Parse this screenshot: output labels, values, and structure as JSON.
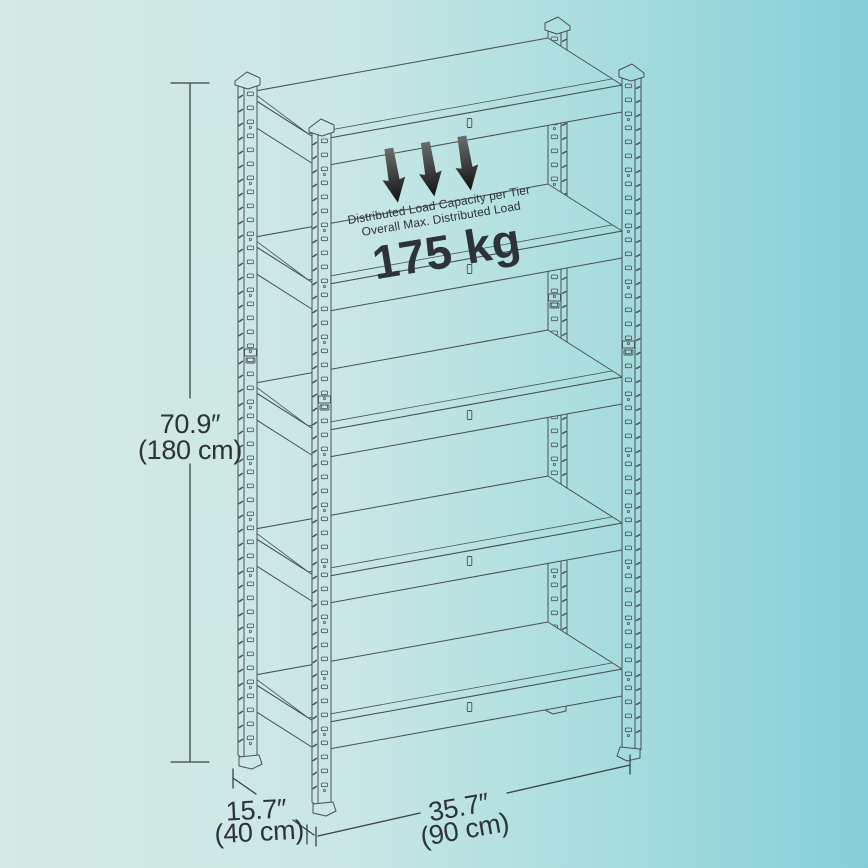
{
  "background": {
    "left": "#d6e9e4",
    "mid": "#c9e7e5",
    "teal": "#a5dcde",
    "right": "#85ced8"
  },
  "colors": {
    "line": "#495054",
    "dim_line": "#3c4246",
    "text": "#2d3337",
    "arrow_top": "#6e6e6e",
    "arrow_bottom": "#0f0f0f"
  },
  "shelving": {
    "tiers": 5
  },
  "load_note": {
    "line1": "Distributed Load Capacity per Tier",
    "line2": "Overall Max. Distributed Load",
    "value": "175 kg",
    "arrow_count": 3
  },
  "dimensions": {
    "height": {
      "imperial": "70.9″",
      "metric": "(180 cm)"
    },
    "depth": {
      "imperial": "15.7″",
      "metric": "(40 cm)"
    },
    "width": {
      "imperial": "35.7″",
      "metric": "(90 cm)"
    }
  }
}
